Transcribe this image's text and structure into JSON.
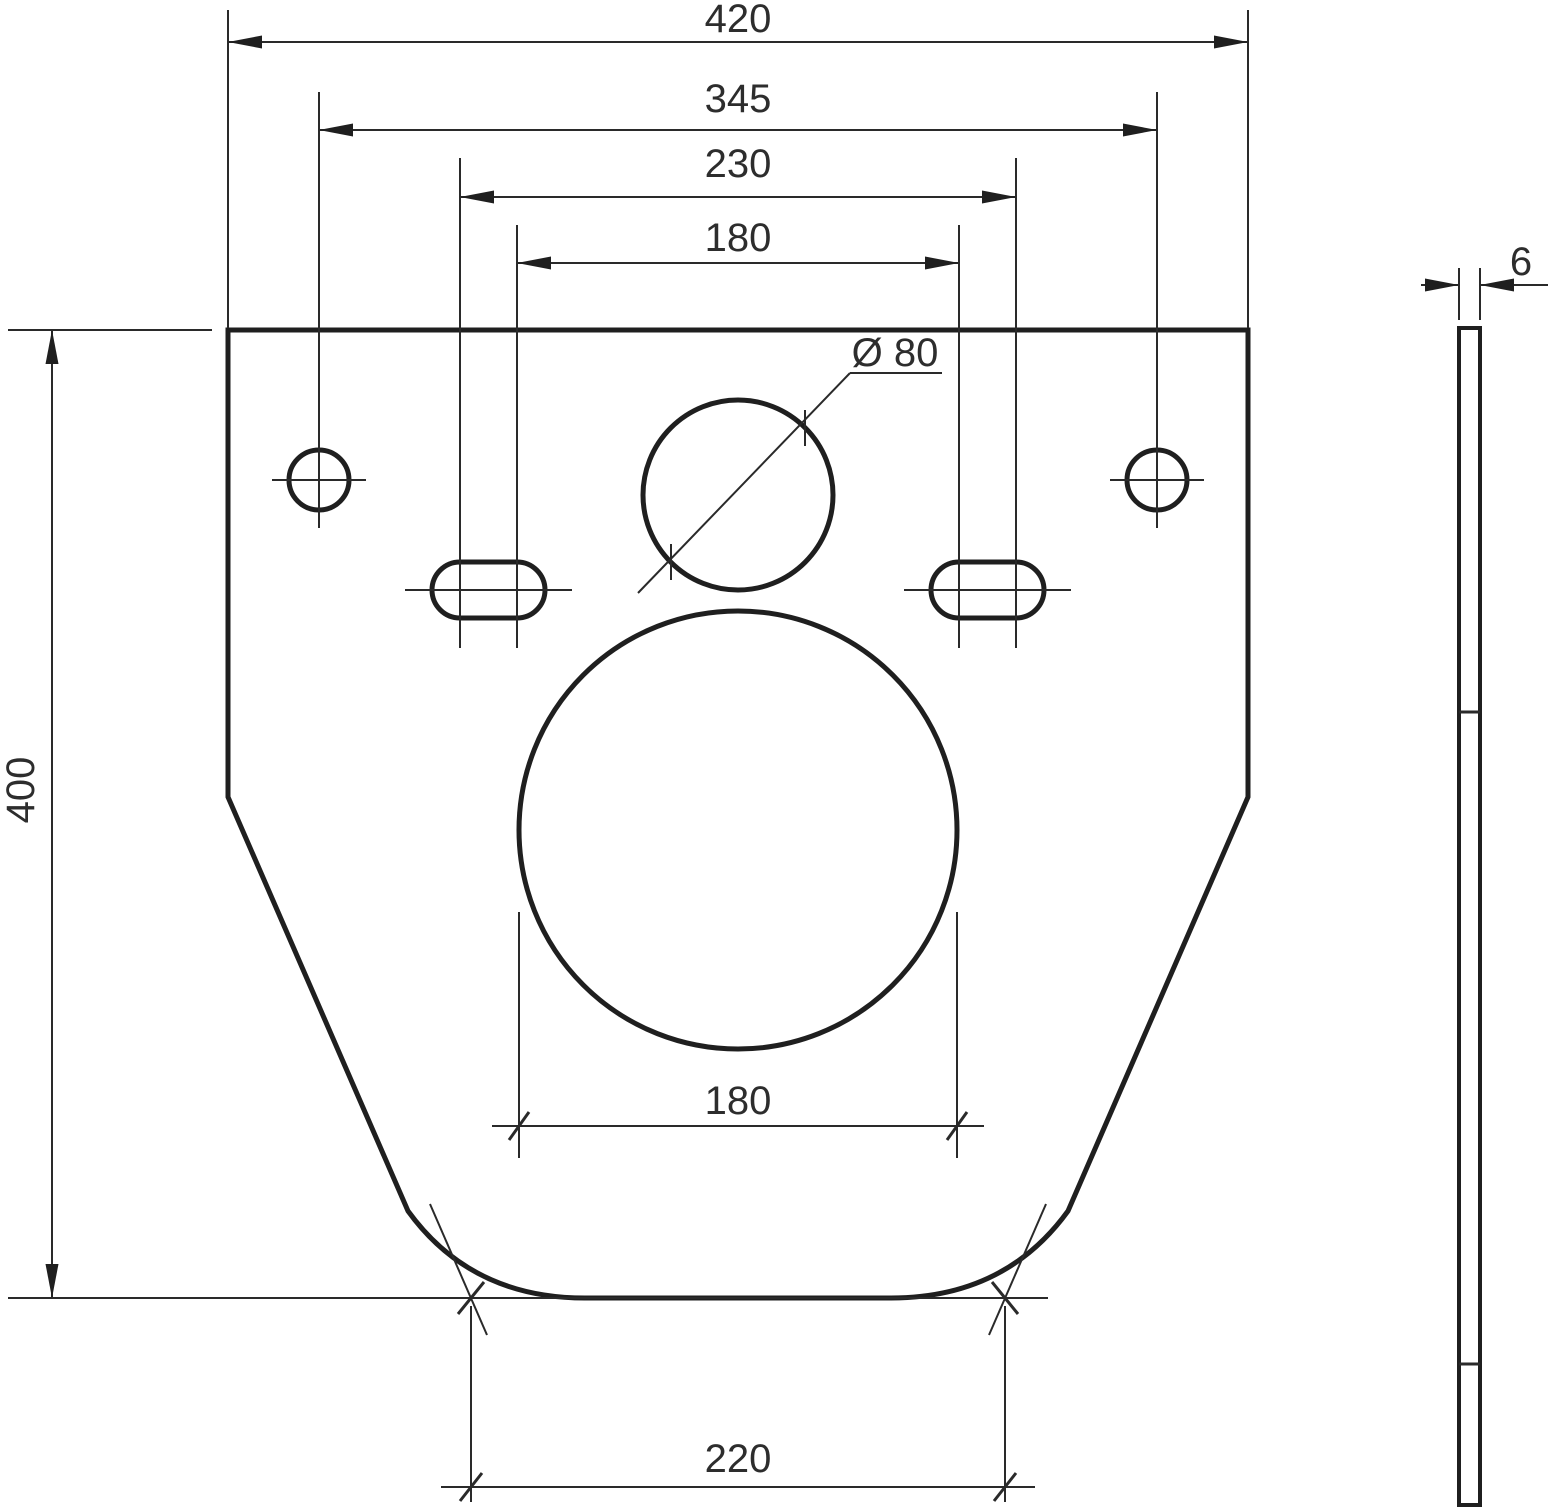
{
  "drawing": {
    "type": "technical-dimension-drawing",
    "subject": "flat plate with mounting holes, front view and side (thickness) view",
    "colors": {
      "background": "#ffffff",
      "line": "#1f1f1f",
      "text": "#2d2d2d"
    },
    "dimensions": {
      "overall_width": "420",
      "mounting_hole_spacing": "345",
      "slot_outer_spacing": "230",
      "slot_inner_spacing": "180",
      "overall_height": "400",
      "pipe_hole_diameter": "Ø 80",
      "drain_hole_width": "180",
      "bottom_edge_width": "220",
      "thickness": "6"
    }
  }
}
